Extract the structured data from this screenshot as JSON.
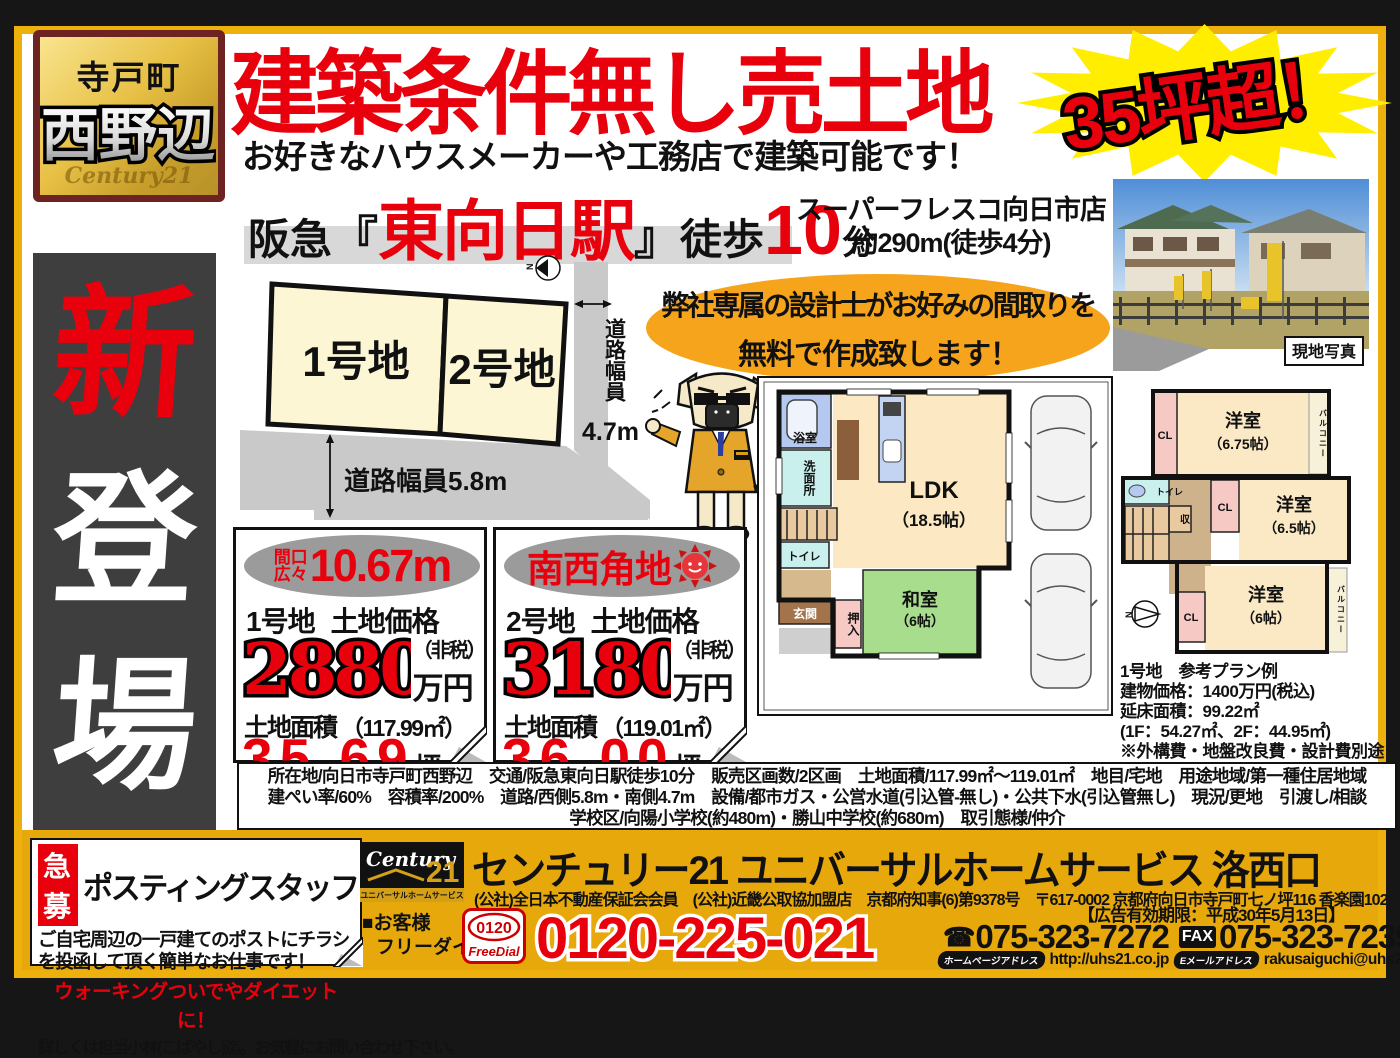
{
  "colors": {
    "accent_red": "#e8000d",
    "frame_gold": "#edb00d",
    "footer_gold": "#e7a80c",
    "burst_yellow": "#ffee00",
    "promo_orange": "#f5a41b",
    "side_banner_bg": "#3e3e3e"
  },
  "badge": {
    "town": "寺戸町",
    "area": "西野辺",
    "watermark": "Century21"
  },
  "side_banner": {
    "chars": [
      "新",
      "登",
      "場"
    ]
  },
  "header": {
    "title": "建築条件無し売土地",
    "burst": "35坪超！",
    "subtitle": "お好きなハウスメーカーや工務店で建築可能です！",
    "station_prefix": "阪急",
    "station_open": "『",
    "station_name": "東向日駅",
    "station_close": "』",
    "walk_label": "徒歩",
    "walk_minutes": "10",
    "walk_unit": "分",
    "supermarket_line1": "スーパーフレスコ向日市店",
    "supermarket_line2": "約290m(徒歩4分)"
  },
  "photo": {
    "caption": "現地写真"
  },
  "lot_map": {
    "lot1": "1号地",
    "lot2": "2号地",
    "road_right_label": "道路幅員",
    "road_right_width": "4.7m",
    "road_bottom_label": "道路幅員5.8m",
    "compass_n": "N"
  },
  "promo": {
    "line1": "弊社専属の設計士がお好みの間取りを",
    "line2": "無料で作成致します！"
  },
  "floorplan_1f": {
    "bath": "浴室",
    "washroom": "洗面所",
    "toilet": "トイレ",
    "entrance": "玄関",
    "oshiire": "押入",
    "washitsu": "和室",
    "washitsu_size": "（6帖）",
    "ldk": "LDK",
    "ldk_size": "（18.5帖）"
  },
  "floorplan_2f": {
    "cl": "CL",
    "toilet": "トイレ",
    "storage": "収",
    "room_675": "洋室",
    "room_675_size": "（6.75帖）",
    "room_65": "洋室",
    "room_65_size": "（6.5帖）",
    "room_6": "洋室",
    "room_6_size": "（6帖）",
    "balcony": "バルコニー"
  },
  "plan_note": {
    "lines": [
      "1号地　参考プラン例",
      "建物価格：1400万円(税込)",
      "延床面積：99.22㎡",
      "(1F：54.27㎡、2F：44.95㎡)",
      "※外構費・地盤改良費・設計費別途要"
    ]
  },
  "price_cards": [
    {
      "badge_line1": "間口",
      "badge_line2": "広々",
      "badge_value": "10.67m",
      "lot": "1号地",
      "price_label": "土地価格",
      "price": "2880",
      "tax_note": "（非税）",
      "unit": "万円",
      "area_label": "土地面積",
      "area_value": "（117.99㎡）",
      "tsubo": "35.69",
      "tsubo_unit": "坪"
    },
    {
      "badge_text": "南西角地",
      "lot": "2号地",
      "price_label": "土地価格",
      "price": "3180",
      "tax_note": "（非税）",
      "unit": "万円",
      "area_label": "土地面積",
      "area_value": "（119.01㎡）",
      "tsubo": "36.00",
      "tsubo_unit": "坪"
    }
  ],
  "details": {
    "lines": [
      "所在地/向日市寺戸町西野辺　交通/阪急東向日駅徒歩10分　販売区画数/2区画　土地面積/117.99㎡～119.01㎡　地目/宅地　用途地域/第一種住居地域",
      "建ぺい率/60%　容積率/200%　道路/西側5.8m・南側4.7m　設備/都市ガス・公営水道(引込管-無し)・公共下水(引込管無し)　現況/更地　引渡し/相談",
      "学校区/向陽小学校(約480m)・勝山中学校(約680m)　取引態様/仲介"
    ]
  },
  "recruit": {
    "tag": "急募",
    "title": "ポスティングスタッフ",
    "body": "ご自宅周辺の一戸建てのポストにチラシを投函して頂く簡単なお仕事です！",
    "highlight": "ウォーキングついでやダイエットに！",
    "contact": "詳しくは担当小林(こばやし)迄。お気軽にお問い合わせ下さい。"
  },
  "footer": {
    "logo_brand": "Century",
    "logo_21": "21",
    "logo_sub": "ユニバーサルホームサービス",
    "company": "センチュリー21 ユニバーサルホームサービス 洛西口",
    "registration": "(公社)全日本不動産保証会会員　(公社)近畿公取協加盟店　京都府知事(6)第9378号　〒617-0002 京都府向日市寺戸町七ノ坪116 香楽園102",
    "customer_line1": "■お客様",
    "customer_line2": "フリーダイヤル",
    "freedial_num": "0120",
    "freedial_label": "FreeDial",
    "phone_main": "0120-225-021",
    "ad_expiry": "【広告有効期限：平成30年5月13日】",
    "tel_icon": "☎",
    "tel": "075-323-7272",
    "fax_label": "FAX",
    "fax": "075-323-7239",
    "web_label": "ホームページアドレス",
    "web": "http://uhs21.co.jp",
    "email_label": "Eメールアドレス",
    "email": "rakusaiguchi@uhs21.co.jp"
  }
}
